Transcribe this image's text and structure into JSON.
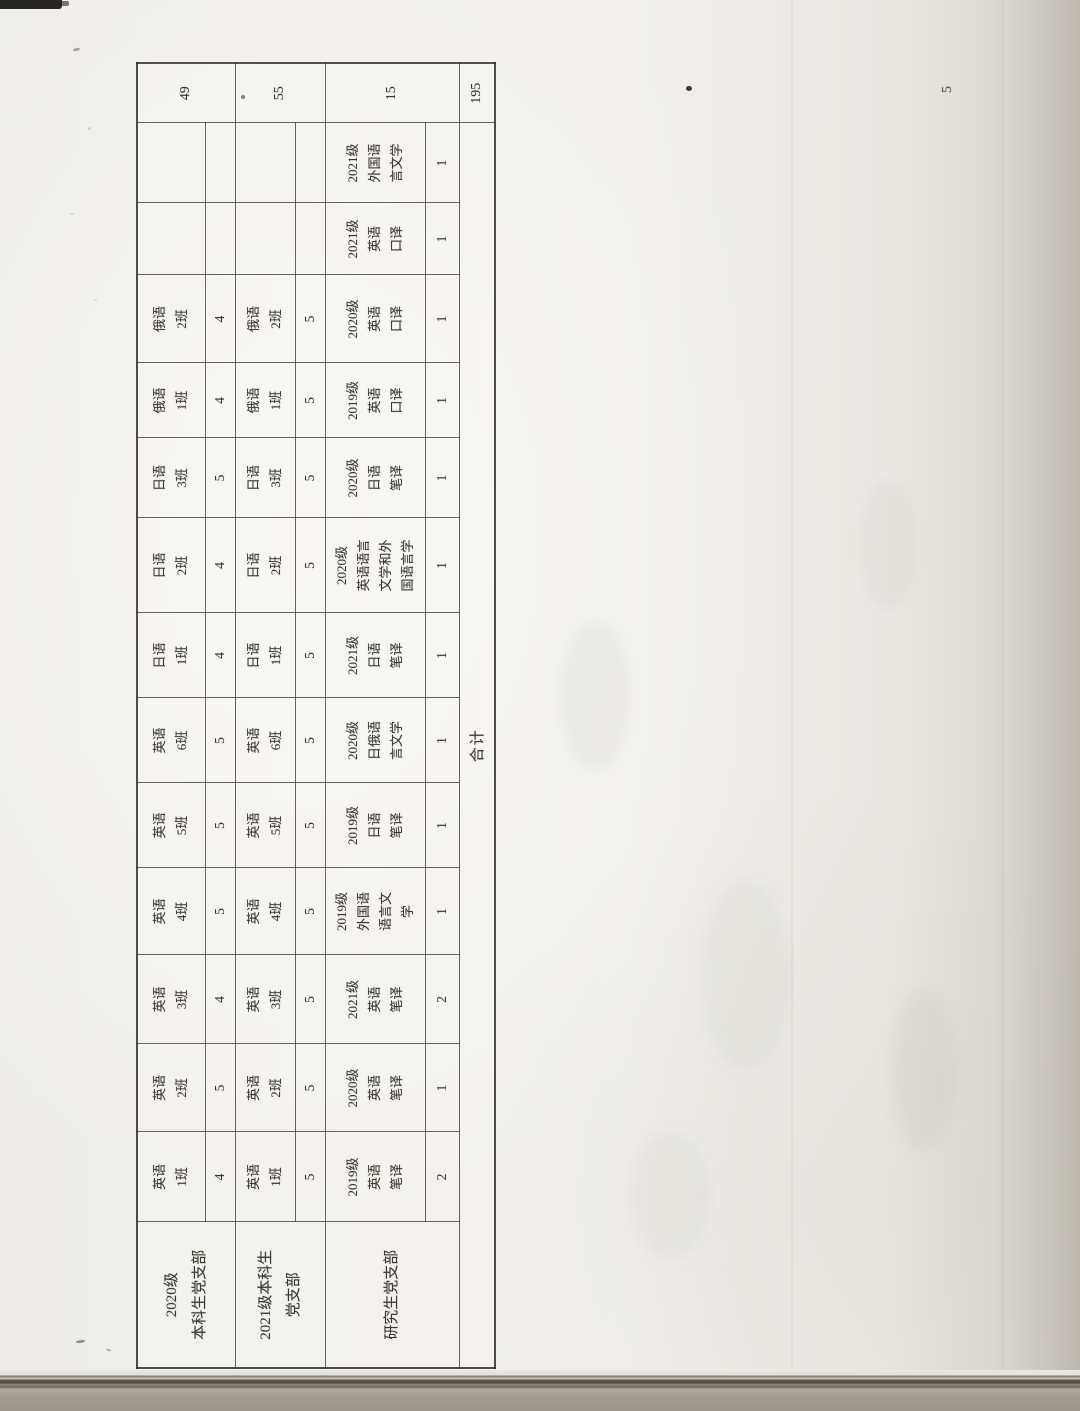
{
  "page": {
    "page_number": "5"
  },
  "document": {
    "type": "scanned-rotated-table",
    "footer_label": "合计",
    "grand_total": "195",
    "groups": [
      {
        "branch": "2020级本科生党支部",
        "branch_lines": [
          "2020级",
          "本科生党支部"
        ],
        "total": "49",
        "entries": [
          {
            "lines": [
              "英语",
              "1班"
            ],
            "count": "4"
          },
          {
            "lines": [
              "英语",
              "2班"
            ],
            "count": "5"
          },
          {
            "lines": [
              "英语",
              "3班"
            ],
            "count": "4"
          },
          {
            "lines": [
              "英语",
              "4班"
            ],
            "count": "5"
          },
          {
            "lines": [
              "英语",
              "5班"
            ],
            "count": "5"
          },
          {
            "lines": [
              "英语",
              "6班"
            ],
            "count": "5"
          },
          {
            "lines": [
              "日语",
              "1班"
            ],
            "count": "4"
          },
          {
            "lines": [
              "日语",
              "2班"
            ],
            "count": "4"
          },
          {
            "lines": [
              "日语",
              "3班"
            ],
            "count": "5"
          },
          {
            "lines": [
              "俄语",
              "1班"
            ],
            "count": "4"
          },
          {
            "lines": [
              "俄语",
              "2班"
            ],
            "count": "4"
          },
          {
            "lines": [],
            "count": ""
          },
          {
            "lines": [],
            "count": ""
          }
        ]
      },
      {
        "branch": "2021级本科生党支部",
        "branch_lines": [
          "2021级本科生",
          "党支部"
        ],
        "total": "55",
        "entries": [
          {
            "lines": [
              "英语",
              "1班"
            ],
            "count": "5"
          },
          {
            "lines": [
              "英语",
              "2班"
            ],
            "count": "5"
          },
          {
            "lines": [
              "英语",
              "3班"
            ],
            "count": "5"
          },
          {
            "lines": [
              "英语",
              "4班"
            ],
            "count": "5"
          },
          {
            "lines": [
              "英语",
              "5班"
            ],
            "count": "5"
          },
          {
            "lines": [
              "英语",
              "6班"
            ],
            "count": "5"
          },
          {
            "lines": [
              "日语",
              "1班"
            ],
            "count": "5"
          },
          {
            "lines": [
              "日语",
              "2班"
            ],
            "count": "5"
          },
          {
            "lines": [
              "日语",
              "3班"
            ],
            "count": "5"
          },
          {
            "lines": [
              "俄语",
              "1班"
            ],
            "count": "5"
          },
          {
            "lines": [
              "俄语",
              "2班"
            ],
            "count": "5"
          },
          {
            "lines": [],
            "count": ""
          },
          {
            "lines": [],
            "count": ""
          }
        ]
      },
      {
        "branch": "研究生党支部",
        "branch_lines": [
          "研究生党支部"
        ],
        "total": "15",
        "entries": [
          {
            "lines": [
              "2019级",
              "英语",
              "笔译"
            ],
            "count": "2"
          },
          {
            "lines": [
              "2020级",
              "英语",
              "笔译"
            ],
            "count": "1"
          },
          {
            "lines": [
              "2021级",
              "英语",
              "笔译"
            ],
            "count": "2"
          },
          {
            "lines": [
              "2019级",
              "外国语",
              "语言文",
              "学"
            ],
            "count": "1"
          },
          {
            "lines": [
              "2019级",
              "日语",
              "笔译"
            ],
            "count": "1"
          },
          {
            "lines": [
              "2020级",
              "日俄语",
              "言文学"
            ],
            "count": "1"
          },
          {
            "lines": [
              "2021级",
              "日语",
              "笔译"
            ],
            "count": "1"
          },
          {
            "lines": [
              "2020级",
              "英语语言",
              "文学和外",
              "国语言学"
            ],
            "count": "1"
          },
          {
            "lines": [
              "2020级",
              "日语",
              "笔译"
            ],
            "count": "1"
          },
          {
            "lines": [
              "2019级",
              "英语",
              "口译"
            ],
            "count": "1"
          },
          {
            "lines": [
              "2020级",
              "英语",
              "口译"
            ],
            "count": "1"
          },
          {
            "lines": [
              "2021级",
              "英语",
              "口译"
            ],
            "count": "1"
          },
          {
            "lines": [
              "2021级",
              "外国语",
              "言文学"
            ],
            "count": "1"
          }
        ]
      }
    ]
  }
}
